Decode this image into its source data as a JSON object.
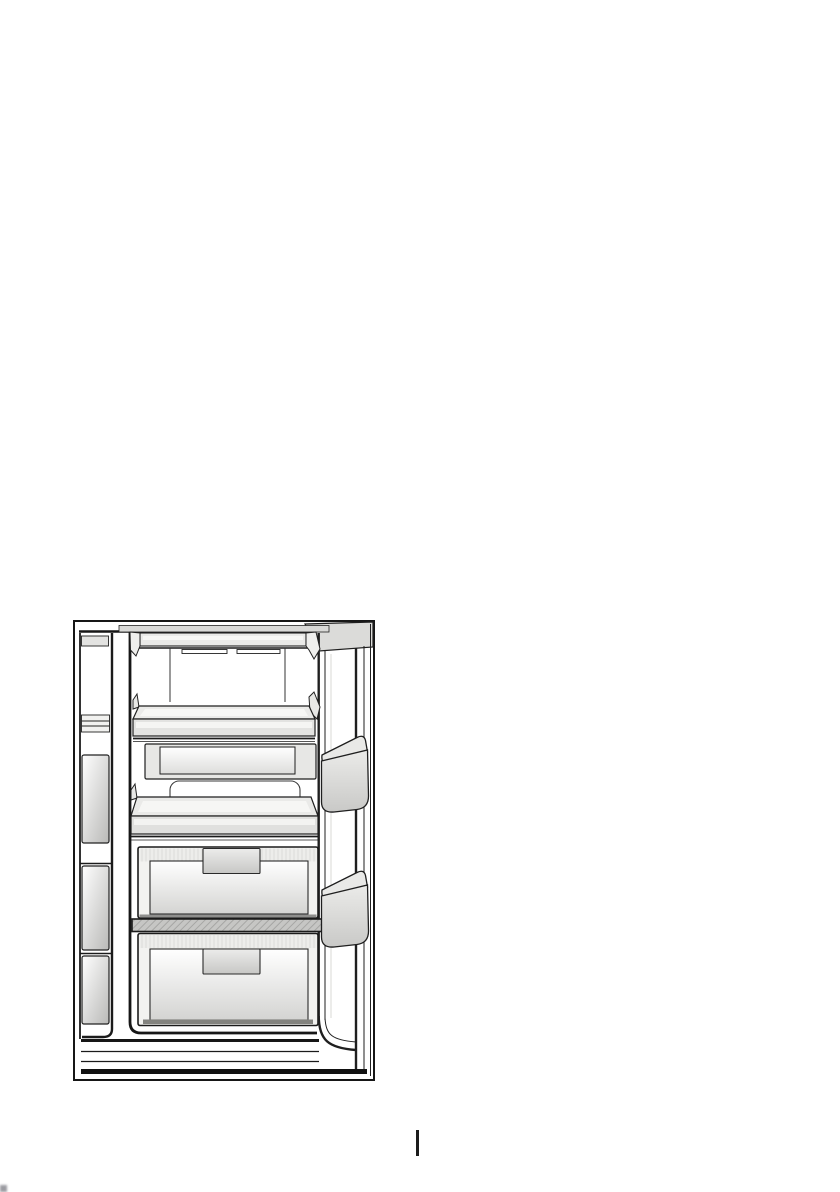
{
  "page": {
    "background": "#ffffff",
    "width_px": 840,
    "height_px": 1192
  },
  "figure": {
    "description": "Black-and-white line drawing of an open freezer compartment of a side-by-side refrigerator: top shelf with two air-vent slots, a glass shelf, an icematic ice tray with recessed front, two large freezer drawers with recessed handles, a hatched divider shelf between the drawers, two triangular bins on the open door at right, the edge of the adjacent compartment with door bins at left, and a base plinth at the bottom.",
    "line_color": "#1b1b1b",
    "fill_light": "#eaeae8",
    "fill_mid": "#c9c9c7",
    "parts": [
      "frame",
      "open-door",
      "left-compartment-edge",
      "top-shelf",
      "air-vent-slots",
      "glass-shelf",
      "icematic-tray",
      "inner-liner-outline",
      "upper-freezer-drawer",
      "upper-drawer-handle",
      "divider-shelf",
      "lower-freezer-drawer",
      "lower-drawer-handle",
      "door-bin-upper",
      "door-bin-lower",
      "base-plinth"
    ]
  },
  "footer": {
    "divider_color": "#1c1c1c"
  },
  "artifacts": {
    "corner_mark_color": "#4a4a55"
  }
}
